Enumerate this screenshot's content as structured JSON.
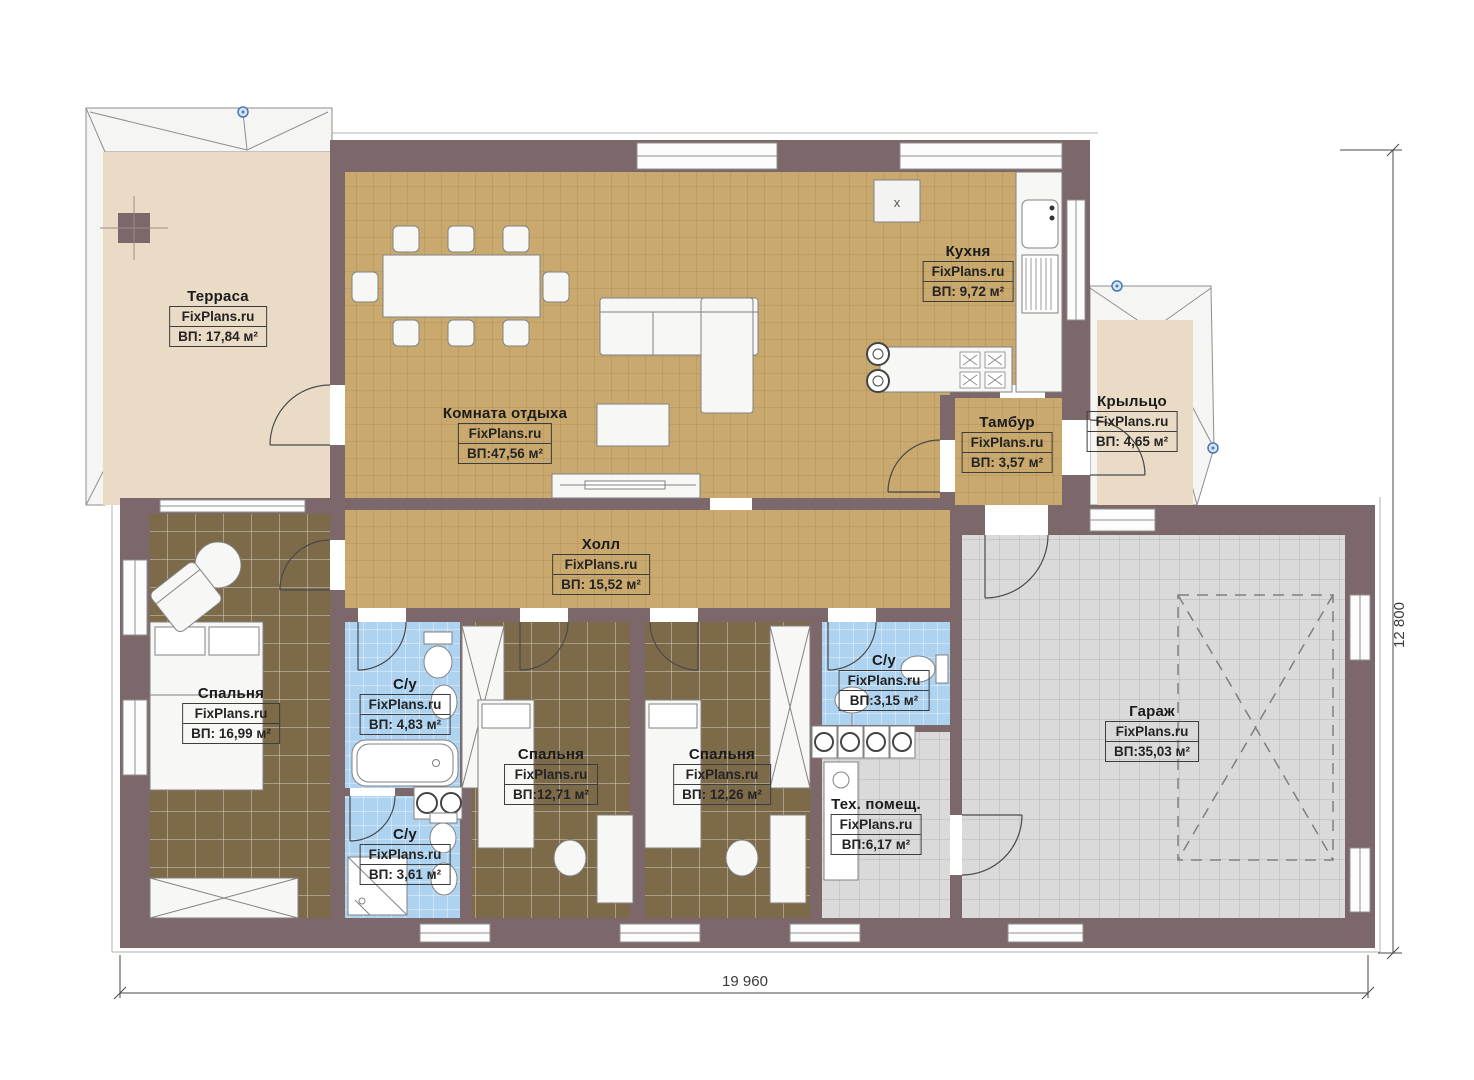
{
  "watermark": "FixPlans.ru",
  "plan": {
    "dimensions": {
      "width_mm": "19 960",
      "height_mm": "12 800"
    },
    "kitchen_marker": "x"
  },
  "rooms": [
    {
      "id": "terrace",
      "name": "Терраса",
      "area": "ВП: 17,84 м²"
    },
    {
      "id": "lounge",
      "name": "Комната отдыха",
      "area": "ВП:47,56 м²"
    },
    {
      "id": "kitchen",
      "name": "Кухня",
      "area": "ВП: 9,72 м²"
    },
    {
      "id": "vestibule",
      "name": "Тамбур",
      "area": "ВП: 3,57 м²"
    },
    {
      "id": "porch",
      "name": "Крыльцо",
      "area": "ВП: 4,65 м²"
    },
    {
      "id": "hall",
      "name": "Холл",
      "area": "ВП: 15,52 м²"
    },
    {
      "id": "bedroom-1",
      "name": "Спальня",
      "area": "ВП: 16,99 м²"
    },
    {
      "id": "bathroom-1",
      "name": "С/у",
      "area": "ВП: 4,83 м²"
    },
    {
      "id": "bathroom-2",
      "name": "С/у",
      "area": "ВП: 3,61 м²"
    },
    {
      "id": "bedroom-2",
      "name": "Спальня",
      "area": "ВП:12,71 м²"
    },
    {
      "id": "bedroom-3",
      "name": "Спальня",
      "area": "ВП: 12,26 м²"
    },
    {
      "id": "bathroom-3",
      "name": "С/у",
      "area": "ВП:3,15 м²"
    },
    {
      "id": "utility",
      "name": "Тех. помещ.",
      "area": "ВП:6,17 м²"
    },
    {
      "id": "garage",
      "name": "Гараж",
      "area": "ВП:35,03 м²"
    }
  ],
  "colors": {
    "wall": "#7c686a",
    "tile_tan": "#c9a96e",
    "tile_brown": "#7c6a49",
    "tile_blue": "#aed3f1",
    "tile_gray": "#dadada",
    "floor_beige": "#e9dbc6",
    "roof_white": "#f5f5f4",
    "marker_blue": "#4a78b0"
  }
}
